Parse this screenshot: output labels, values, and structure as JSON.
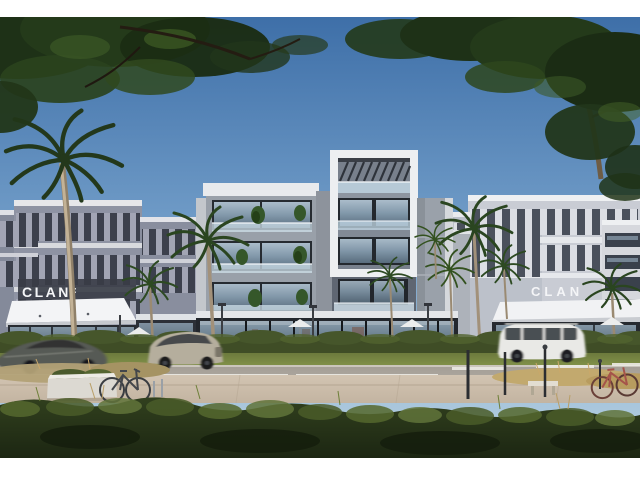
{
  "image": {
    "kind": "architectural exterior rendering",
    "description": "Street view of a modern mixed-use residential complex with ground-floor retail, framed by dark tree canopies, palm trees, passing cars, bicycles and a landscaped hedge foreground",
    "letterbox": "white bands at top and bottom of the frame"
  },
  "signs": {
    "left": "CLAN",
    "right": "CLAN"
  },
  "palette": {
    "sky_top": "#3e6fa8",
    "sky_horizon": "#b9d2e2",
    "foliage_dark": "#1e3117",
    "foliage_light": "#61743a",
    "facade_gray": "#99a0a9",
    "facade_slate": "#8e93a3",
    "facade_white": "#edeff1",
    "storefront_dark": "#23272d",
    "window_glass": "#9db3c4",
    "canopy_white": "#f3f4f6",
    "road": "#a59f97",
    "sidewalk": "#d2c4b2",
    "hedge_green": "#3f4d26",
    "car_dark": "#565a54",
    "car_silver": "#b5ae9d",
    "car_white": "#e9e9e6",
    "bike_red": "#a5544a",
    "palm_trunk": "#b9a88c"
  },
  "objects": {
    "vehicles": [
      "dark sports sedan with motion blur",
      "silver pickup SUV with motion blur",
      "white boxy SUV with motion blur"
    ],
    "bicycles": [
      "city bike at rack",
      "red bicycle near bench"
    ],
    "vegetation": [
      "overhanging tree canopy top-left",
      "overhanging tree canopy top-right",
      "tall palm",
      "storefront palms",
      "hedge row",
      "foreground shrubs",
      "ornamental tan grasses"
    ],
    "street_furniture": [
      "white planter box",
      "stone bench",
      "bollards",
      "street lamps",
      "cafe umbrellas",
      "cafe tables"
    ]
  }
}
